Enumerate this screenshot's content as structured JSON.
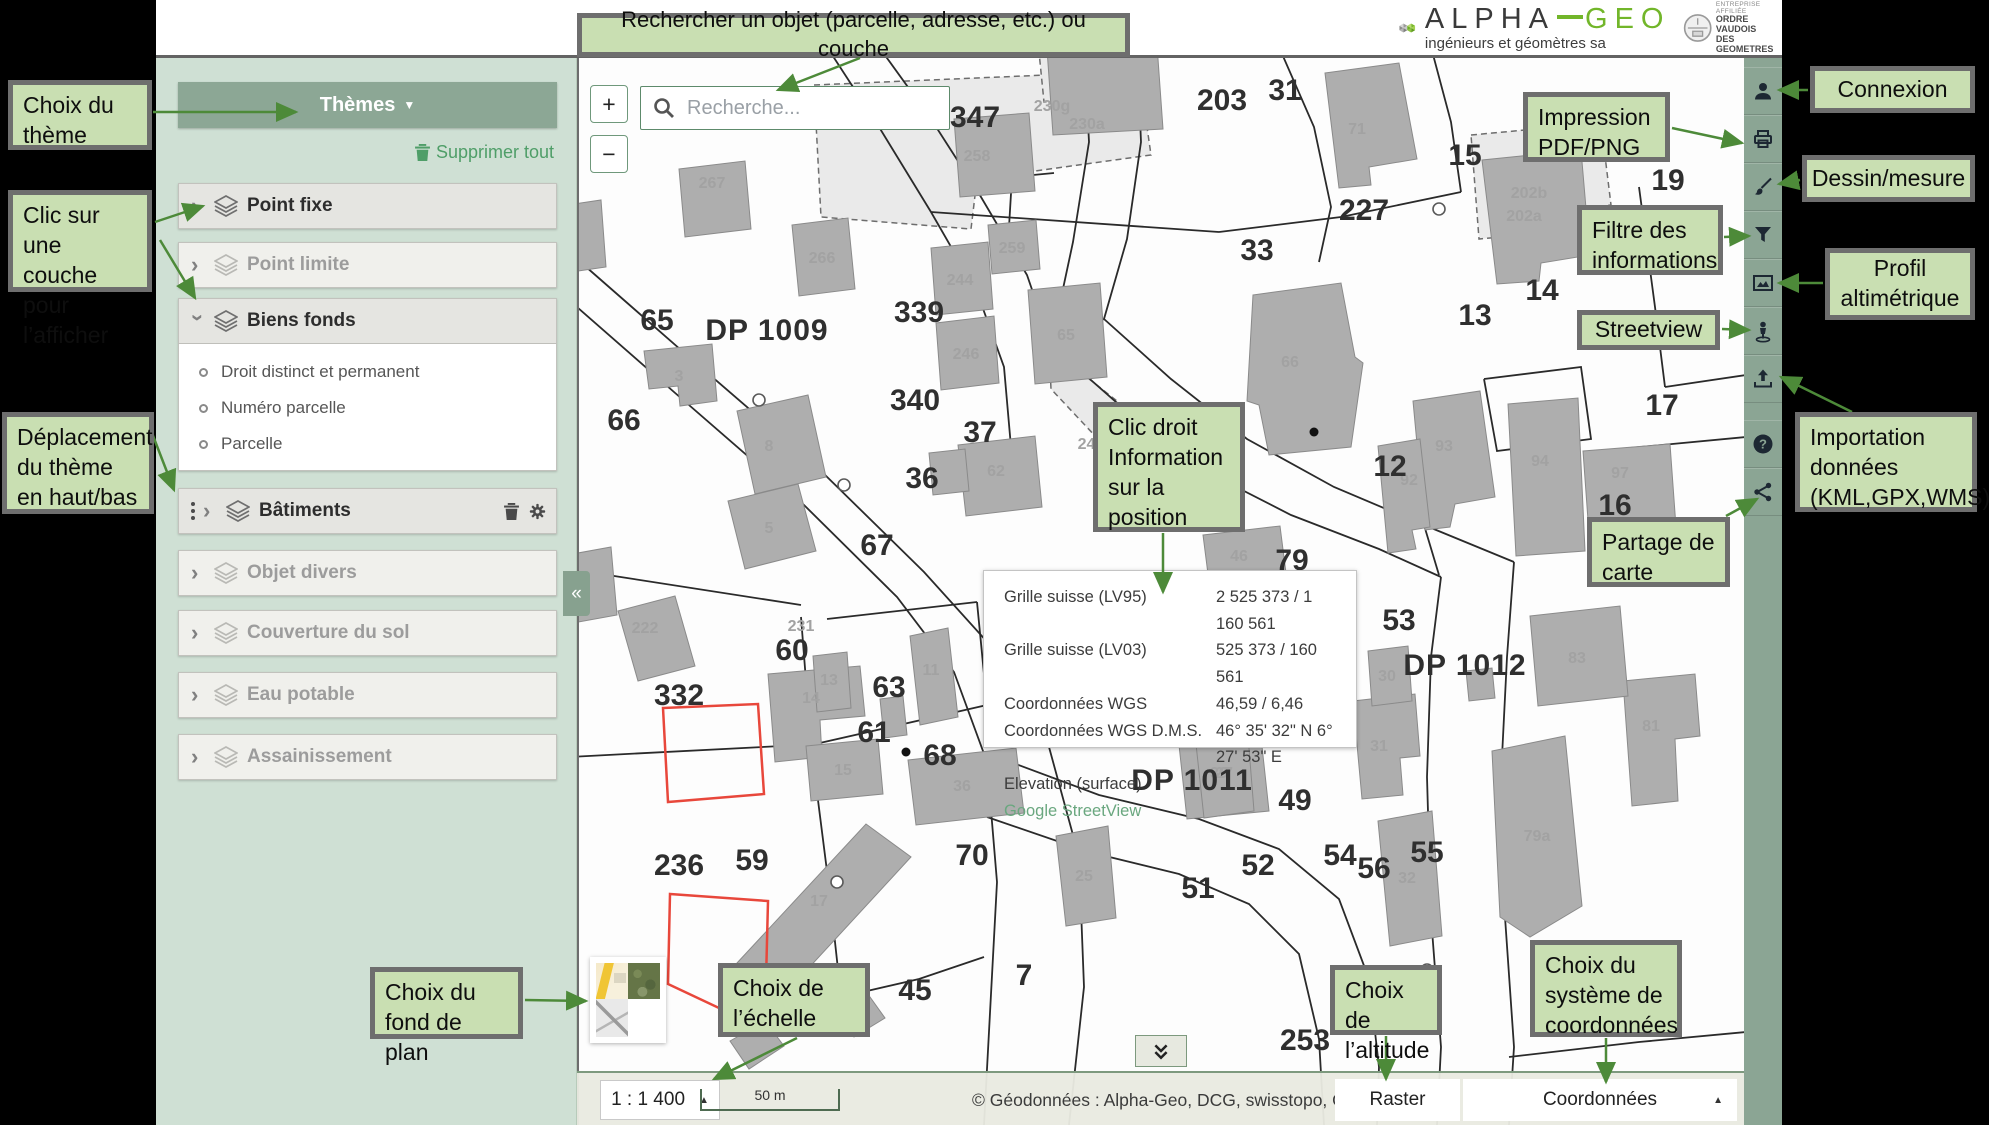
{
  "header": {
    "brand_main": "ALPHA",
    "brand_accent": "GEO",
    "brand_subtitle": "ingénieurs et géomètres sa",
    "badge_lines": [
      "ENTREPRISE AFFILIÉE",
      "ORDRE VAUDOIS",
      "DES GEOMETRES"
    ]
  },
  "callouts": {
    "search_hint": "Rechercher un objet (parcelle, adresse, etc.) ou couche",
    "theme_choice": "Choix du thème",
    "layer_click": "Clic sur une couche pour l’afficher",
    "theme_move": "Déplacement du thème en haut/bas",
    "print": "Impression PDF/PNG",
    "filter": "Filtre des informations",
    "streetview": "Streetview",
    "share": "Partage de carte",
    "connexion": "Connexion",
    "draw": "Dessin/mesure",
    "profile": "Profil altimétrique",
    "import": "Importation données (KML,GPX,WMS)",
    "right_click": "Clic droit Information sur la position",
    "basemap": "Choix du fond de plan",
    "scale": "Choix de l’échelle",
    "altitude": "Choix de l’altitude",
    "coords": "Choix du système de coordonnées"
  },
  "sidebar": {
    "themes_label": "Thèmes",
    "clear_all": "Supprimer tout",
    "layers": [
      {
        "label": "Point fixe",
        "state": "active",
        "expanded": false
      },
      {
        "label": "Point limite",
        "state": "inactive",
        "expanded": false
      },
      {
        "label": "Biens fonds",
        "state": "active",
        "expanded": true,
        "children": [
          "Droit distinct et permanent",
          "Numéro parcelle",
          "Parcelle"
        ]
      },
      {
        "label": "Bâtiments",
        "state": "active",
        "expanded": false,
        "draggable": true,
        "actions": true
      },
      {
        "label": "Objet divers",
        "state": "inactive",
        "expanded": false
      },
      {
        "label": "Couverture du sol",
        "state": "inactive",
        "expanded": false
      },
      {
        "label": "Eau potable",
        "state": "inactive",
        "expanded": false
      },
      {
        "label": "Assainissement",
        "state": "inactive",
        "expanded": false
      }
    ]
  },
  "map": {
    "search_placeholder": "Recherche...",
    "zoom_in": "+",
    "zoom_out": "−",
    "collapse_left": "«",
    "popup": {
      "rows": [
        {
          "label": "Grille suisse (LV95)",
          "value": "2 525 373 / 1 160 561"
        },
        {
          "label": "Grille suisse (LV03)",
          "value": "525 373 / 160 561"
        },
        {
          "label": "Coordonnées WGS",
          "value": "46,59 / 6,46"
        },
        {
          "label": "Coordonnées WGS D.M.S.",
          "value": "46° 35' 32\" N 6° 27' 53\" E"
        },
        {
          "label": "Elevation (surface)",
          "value": ""
        }
      ],
      "link": "Google StreetView"
    },
    "parcel_labels": [
      {
        "t": "347",
        "x": 396,
        "y": 70
      },
      {
        "t": "203",
        "x": 643,
        "y": 53
      },
      {
        "t": "31",
        "x": 706,
        "y": 43
      },
      {
        "t": "227",
        "x": 785,
        "y": 163
      },
      {
        "t": "15",
        "x": 886,
        "y": 108
      },
      {
        "t": "19",
        "x": 1089,
        "y": 133
      },
      {
        "t": "33",
        "x": 678,
        "y": 203
      },
      {
        "t": "13",
        "x": 896,
        "y": 268
      },
      {
        "t": "14",
        "x": 963,
        "y": 243
      },
      {
        "t": "12",
        "x": 811,
        "y": 419
      },
      {
        "t": "17",
        "x": 1083,
        "y": 358
      },
      {
        "t": "16",
        "x": 1036,
        "y": 458
      },
      {
        "t": "79",
        "x": 713,
        "y": 513
      },
      {
        "t": "65",
        "x": 78,
        "y": 273
      },
      {
        "t": "66",
        "x": 45,
        "y": 373
      },
      {
        "t": "339",
        "x": 340,
        "y": 265
      },
      {
        "t": "340",
        "x": 336,
        "y": 353
      },
      {
        "t": "37",
        "x": 401,
        "y": 385
      },
      {
        "t": "36",
        "x": 343,
        "y": 431
      },
      {
        "t": "67",
        "x": 298,
        "y": 498
      },
      {
        "t": "332",
        "x": 100,
        "y": 648
      },
      {
        "t": "60",
        "x": 213,
        "y": 603
      },
      {
        "t": "63",
        "x": 310,
        "y": 640
      },
      {
        "t": "61",
        "x": 295,
        "y": 685
      },
      {
        "t": "68",
        "x": 361,
        "y": 708
      },
      {
        "t": "236",
        "x": 100,
        "y": 818
      },
      {
        "t": "59",
        "x": 173,
        "y": 813
      },
      {
        "t": "70",
        "x": 393,
        "y": 808
      },
      {
        "t": "45",
        "x": 336,
        "y": 943
      },
      {
        "t": "7",
        "x": 445,
        "y": 928
      },
      {
        "t": "53",
        "x": 820,
        "y": 573
      },
      {
        "t": "49",
        "x": 716,
        "y": 753
      },
      {
        "t": "52",
        "x": 679,
        "y": 818
      },
      {
        "t": "51",
        "x": 619,
        "y": 841
      },
      {
        "t": "54",
        "x": 761,
        "y": 808
      },
      {
        "t": "56",
        "x": 795,
        "y": 821
      },
      {
        "t": "55",
        "x": 848,
        "y": 805
      },
      {
        "t": "253",
        "x": 726,
        "y": 993
      }
    ],
    "road_labels": [
      {
        "t": "DP 1009",
        "x": 188,
        "y": 283
      },
      {
        "t": "DP 1012",
        "x": 886,
        "y": 618
      },
      {
        "t": "DP 1011",
        "x": 613,
        "y": 733
      }
    ],
    "building_labels": [
      {
        "t": "258",
        "x": 398,
        "y": 104
      },
      {
        "t": "259",
        "x": 433,
        "y": 196
      },
      {
        "t": "267",
        "x": 133,
        "y": 131
      },
      {
        "t": "266",
        "x": 243,
        "y": 206
      },
      {
        "t": "244",
        "x": 381,
        "y": 228
      },
      {
        "t": "246",
        "x": 387,
        "y": 302
      },
      {
        "t": "230g",
        "x": 473,
        "y": 54
      },
      {
        "t": "230a",
        "x": 508,
        "y": 72
      },
      {
        "t": "202b",
        "x": 950,
        "y": 141
      },
      {
        "t": "202a",
        "x": 945,
        "y": 164
      },
      {
        "t": "71",
        "x": 778,
        "y": 77
      },
      {
        "t": "65",
        "x": 487,
        "y": 283
      },
      {
        "t": "66",
        "x": 711,
        "y": 310
      },
      {
        "t": "3",
        "x": 100,
        "y": 324
      },
      {
        "t": "8",
        "x": 190,
        "y": 394
      },
      {
        "t": "5",
        "x": 190,
        "y": 476
      },
      {
        "t": "62",
        "x": 417,
        "y": 419
      },
      {
        "t": "46",
        "x": 660,
        "y": 504
      },
      {
        "t": "93",
        "x": 865,
        "y": 394
      },
      {
        "t": "94",
        "x": 961,
        "y": 409
      },
      {
        "t": "97",
        "x": 1041,
        "y": 421
      },
      {
        "t": "92",
        "x": 830,
        "y": 428
      },
      {
        "t": "222",
        "x": 66,
        "y": 576
      },
      {
        "t": "231",
        "x": 222,
        "y": 574
      },
      {
        "t": "13",
        "x": 250,
        "y": 628
      },
      {
        "t": "14",
        "x": 232,
        "y": 646
      },
      {
        "t": "15",
        "x": 264,
        "y": 718
      },
      {
        "t": "11",
        "x": 352,
        "y": 618
      },
      {
        "t": "36",
        "x": 383,
        "y": 734
      },
      {
        "t": "39",
        "x": 640,
        "y": 721
      },
      {
        "t": "17",
        "x": 240,
        "y": 849
      },
      {
        "t": "79a",
        "x": 958,
        "y": 784
      },
      {
        "t": "81",
        "x": 1072,
        "y": 674
      },
      {
        "t": "83",
        "x": 998,
        "y": 606
      },
      {
        "t": "31",
        "x": 800,
        "y": 694
      },
      {
        "t": "30",
        "x": 808,
        "y": 624
      },
      {
        "t": "32",
        "x": 828,
        "y": 826
      },
      {
        "t": "27",
        "x": 645,
        "y": 721
      },
      {
        "t": "25",
        "x": 505,
        "y": 824
      },
      {
        "t": "245",
        "x": 512,
        "y": 392
      },
      {
        "t": "203",
        "x": 277,
        "y": 968
      }
    ]
  },
  "statusbar": {
    "scale": "1 : 1 400",
    "scalebar": "50 m",
    "attribution": "© Géodonnées : Alpha-Geo, DCG, swisstopo, OSM",
    "altitude": "Raster",
    "coords": "Coordonnées"
  }
}
